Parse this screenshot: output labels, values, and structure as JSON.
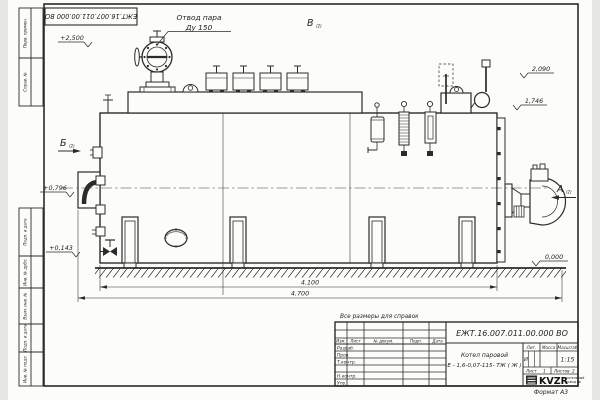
{
  "colors": {
    "ink": "#2b2b2b",
    "paper": "#fcfcfa",
    "background": "#e6e6e3"
  },
  "doc": {
    "number": "ЕЖТ.16.007.011.00.000 ВО",
    "format": "Формат А3",
    "note": "Все размеры для справок"
  },
  "callout": {
    "line1": "Отвод пара",
    "line2": "Ду 150"
  },
  "views": {
    "a": "А",
    "b": "Б",
    "v": "В",
    "ref": "(2)"
  },
  "elevations": {
    "plus2500": "+2,500",
    "v2090": "2,090",
    "v1746": "1,746",
    "plus0796": "+0,796",
    "plus0143": "+0,143",
    "zero": "0,000"
  },
  "dimensions": {
    "inner": "4.100",
    "overall": "4.700"
  },
  "frame_labels": {
    "perv": "Перв. примен.",
    "sprav": "Справ. №",
    "podp1": "Подп. и дата",
    "inv_dubl": "Инв. № дубл.",
    "vzam": "Взам. инв. №",
    "podp2": "Подп. и дата",
    "inv_podl": "Инв. № подл."
  },
  "title_block": {
    "doc_number": "ЕЖТ.16.007.011.00.000 ВО",
    "name_line1": "Котел паровой",
    "name_line2": "Е - 1,6-0,07-115- ТЖ ( Ж )",
    "col_izm": "Изм.",
    "col_list": "Лист",
    "col_doc": "№ докум.",
    "col_podp": "Подп.",
    "col_data": "Дата",
    "row_razrab": "Разраб.",
    "row_prov": "Пров.",
    "row_tkontr": "Т.контр.",
    "row_nkontr": "Н.контр.",
    "row_utv": "Утв.",
    "lit": "Лит.",
    "massa": "Масса",
    "masshtab": "Масштаб",
    "lit_value": "И",
    "scale_value": "1:15",
    "list_label": "Лист",
    "list_value": "1",
    "listov_label": "Листов",
    "listov_value": "2",
    "brand": "KVZR",
    "brand_sub1": "КОТЕЛЬНЫЙ",
    "brand_sub2": "ЗАВОД РФ"
  }
}
